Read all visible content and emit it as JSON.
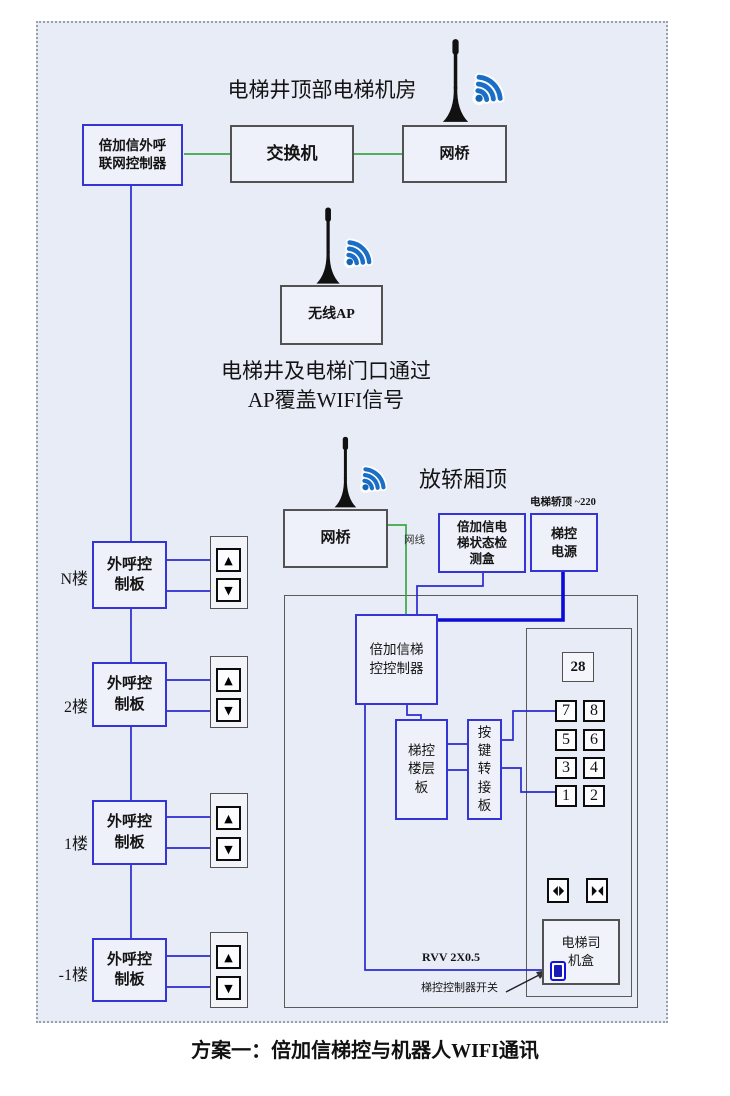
{
  "caption": "方案一：倍加信梯控与机器人WIFI通讯",
  "colors": {
    "line_green": "#3aa845",
    "line_blue": "#2a2ad0",
    "line_power_blue": "#0b0bd6",
    "wifi_blue": "#1a6ec5"
  },
  "machine_room": {
    "title": "电梯井顶部电梯机房",
    "outcall_controller": "倍加信外呼\n联网控制器",
    "ethernet_switch": "交换机",
    "bridge": "网桥"
  },
  "ap": {
    "label": "无线AP",
    "note_line1": "电梯井及电梯门口通过",
    "note_line2": "AP覆盖WIFI信号"
  },
  "cab": {
    "title": "放轿厢顶",
    "power_note": "电梯轿顶 ~220",
    "bridge": "网桥",
    "cable_label": "网线",
    "status_box": "倍加信电\n梯状态检\n测盒",
    "power_box": "梯控\n电源",
    "controller": "倍加信梯\n控控制器",
    "floor_board": "梯控\n楼层\n板",
    "key_adapter": "按\n键\n转\n接\n板",
    "display_value": "28",
    "buttons": [
      "7",
      "8",
      "5",
      "6",
      "3",
      "4",
      "1",
      "2"
    ],
    "driver_box": "电梯司\n机盒",
    "rvv_label": "RVV 2X0.5",
    "switch_label": "梯控控制器开关"
  },
  "floors": {
    "board_label": "外呼控\n制板",
    "up_icon": "▲",
    "down_icon": "▼",
    "items": [
      {
        "floor": "N楼"
      },
      {
        "floor": "2楼"
      },
      {
        "floor": "1楼"
      },
      {
        "floor": "-1楼"
      }
    ]
  }
}
